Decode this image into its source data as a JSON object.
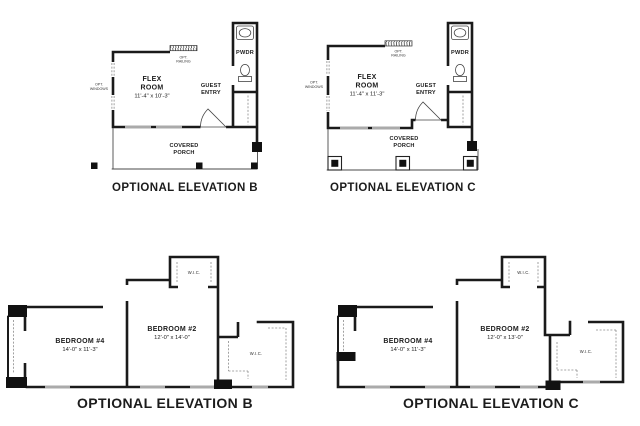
{
  "colors": {
    "wall": "#1a1a1a",
    "thin_line": "#4a4a4a",
    "dashed_line": "#8a8a8a",
    "background": "#ffffff"
  },
  "plans": {
    "flex_b": {
      "caption": "OPTIONAL ELEVATION B",
      "room1": "FLEX",
      "room2": "ROOM",
      "dims": "11'-4\" x 10'-3\"",
      "pwdr": "PWDR",
      "guest1": "GUEST",
      "guest2": "ENTRY",
      "porch1": "COVERED",
      "porch2": "PORCH",
      "railing1": "OPT.",
      "railing2": "RAILING",
      "windows1": "OPT.",
      "windows2": "WINDOWS"
    },
    "flex_c": {
      "caption": "OPTIONAL ELEVATION C",
      "room1": "FLEX",
      "room2": "ROOM",
      "dims": "11'-4\" x 11'-3\"",
      "pwdr": "PWDR",
      "guest1": "GUEST",
      "guest2": "ENTRY",
      "porch1": "COVERED",
      "porch2": "PORCH",
      "railing1": "OPT.",
      "railing2": "RAILING",
      "windows1": "OPT.",
      "windows2": "WINDOWS"
    },
    "bed_b": {
      "caption": "OPTIONAL ELEVATION B",
      "b4": "BEDROOM #4",
      "b4_dims": "14'-0\" x 11'-3\"",
      "b2": "BEDROOM #2",
      "b2_dims": "12'-0\" x 14'-0\"",
      "wic_top": "W.I.C.",
      "wic_right": "W.I.C."
    },
    "bed_c": {
      "caption": "OPTIONAL ELEVATION C",
      "b4": "BEDROOM #4",
      "b4_dims": "14'-0\" x 11'-3\"",
      "b2": "BEDROOM #2",
      "b2_dims": "12'-0\" x 13'-0\"",
      "wic_top": "W.I.C.",
      "wic_right": "W.I.C."
    }
  }
}
